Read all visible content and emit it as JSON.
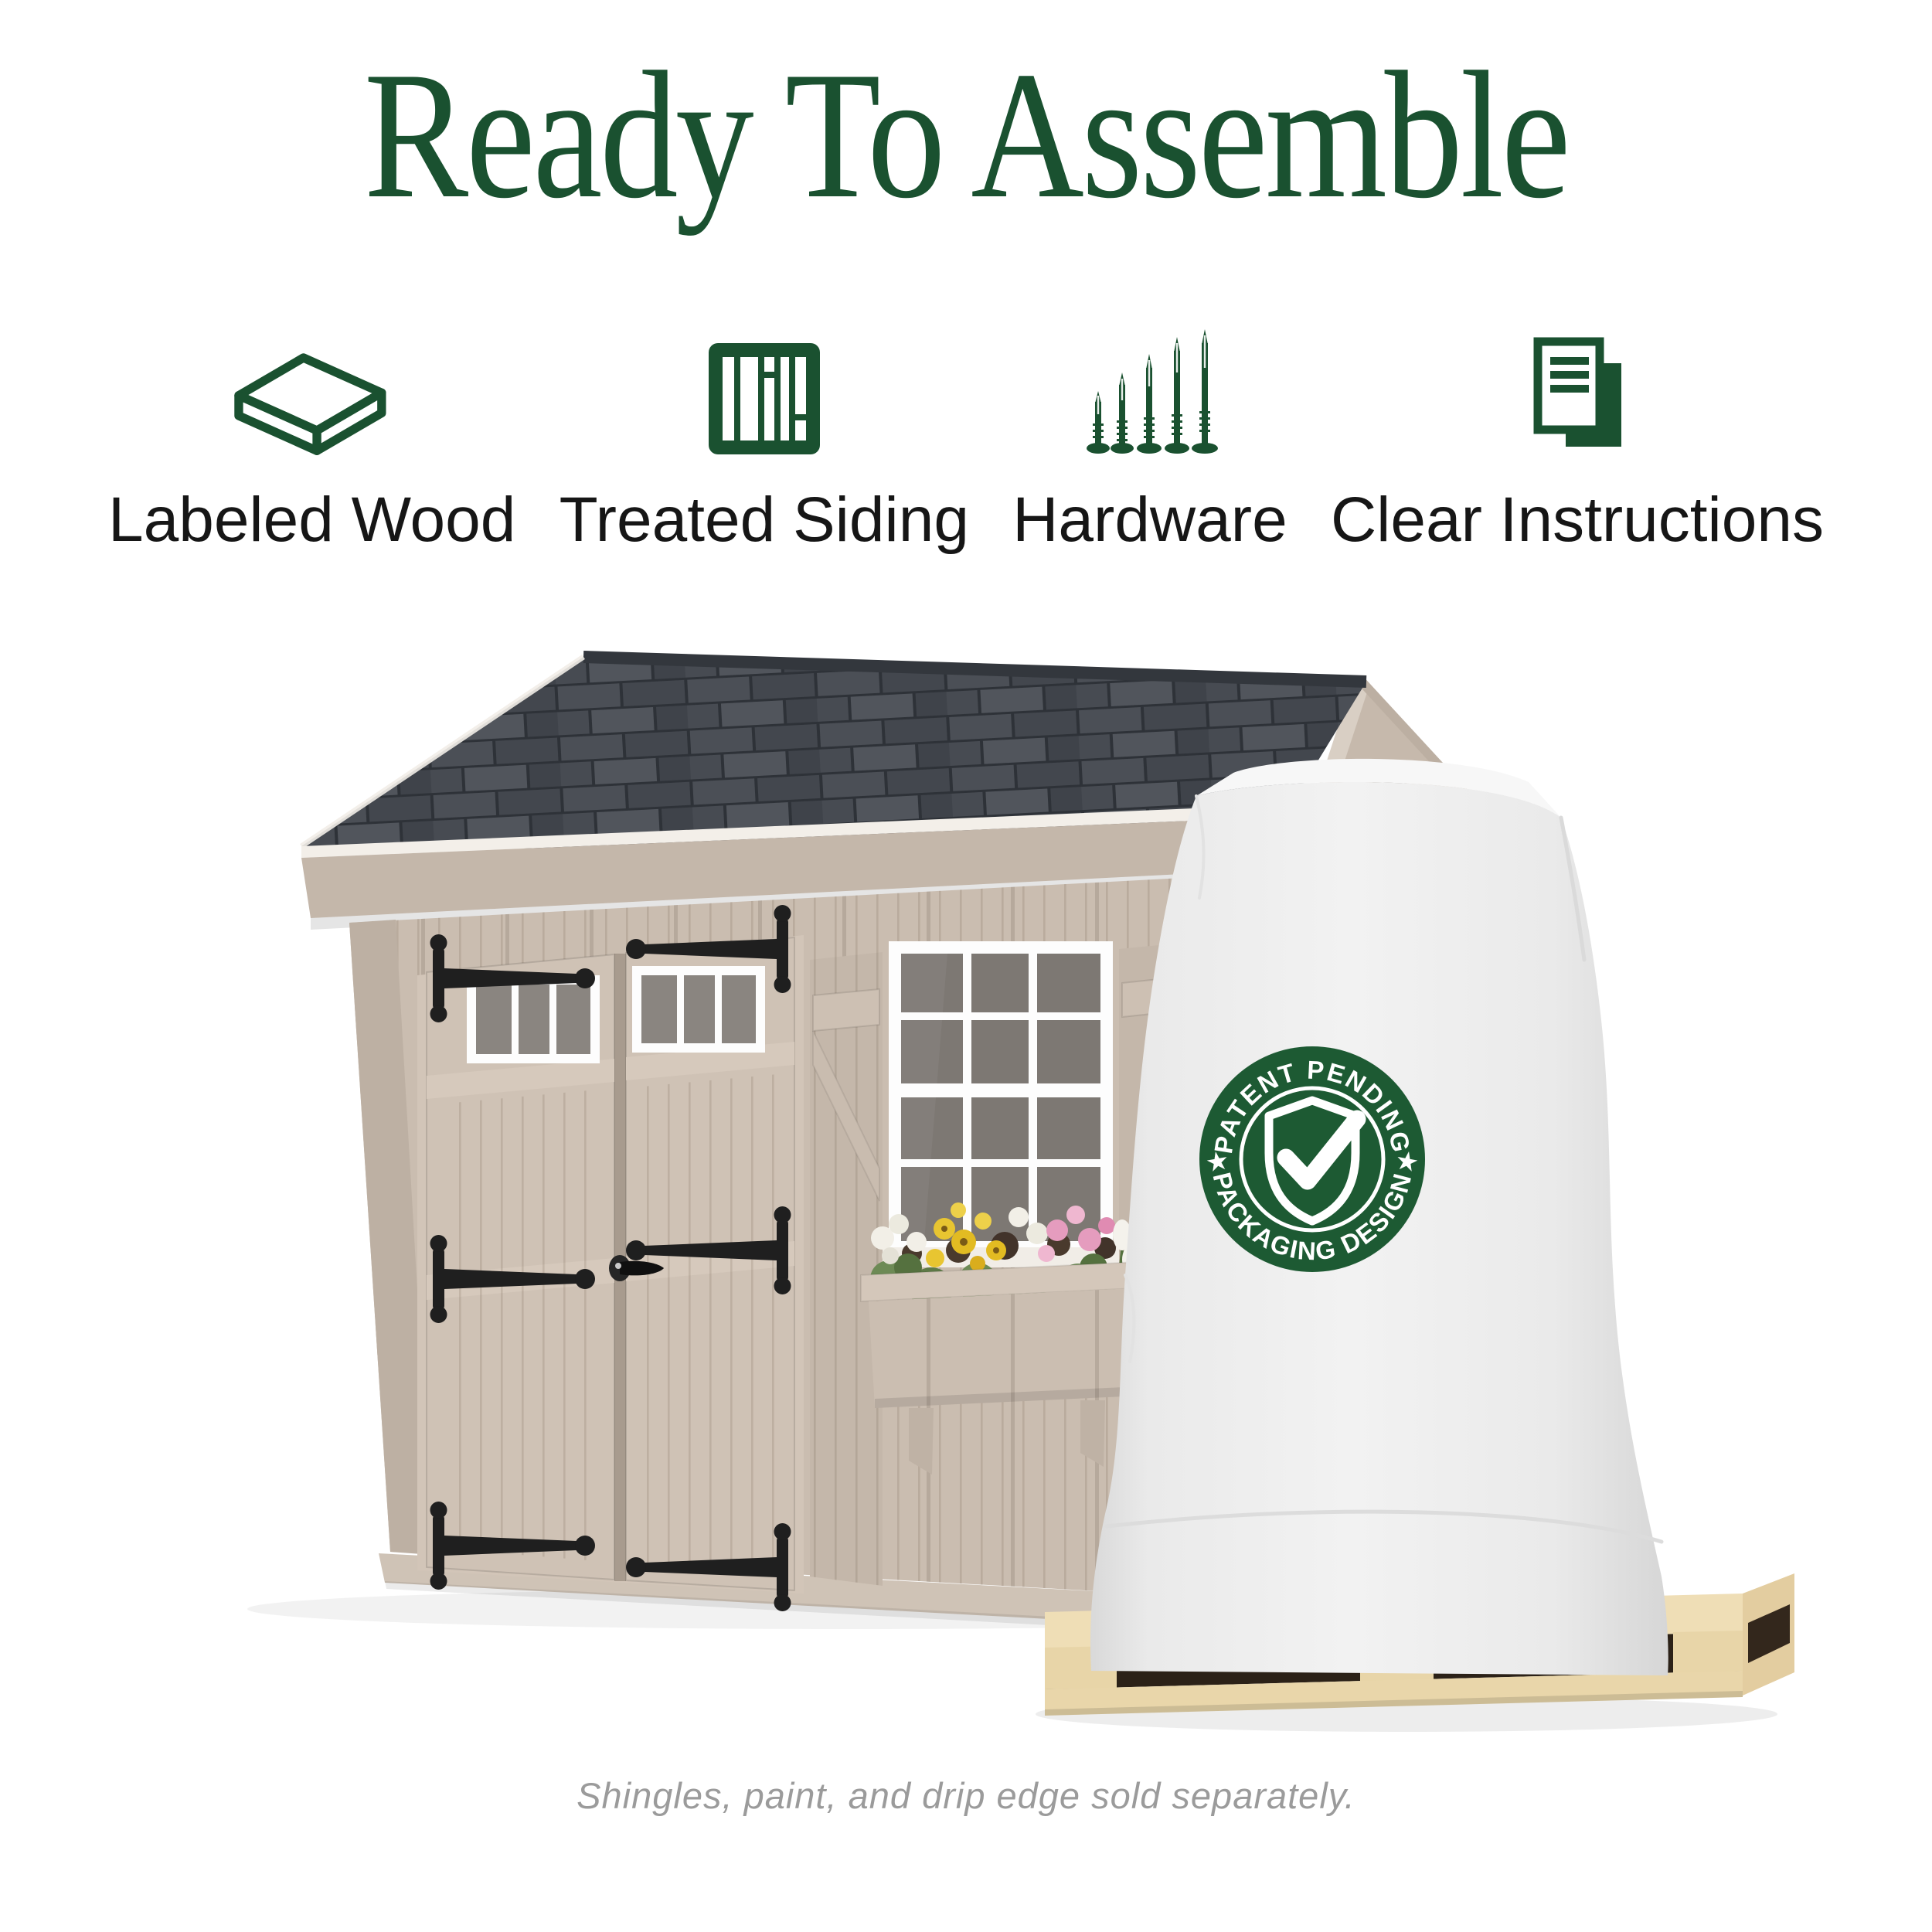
{
  "page": {
    "background": "#ffffff"
  },
  "title": {
    "text": "Ready To Assemble",
    "color": "#1A5130"
  },
  "features": {
    "icon_color": "#1A5130",
    "label_color": "#161616",
    "items": [
      {
        "label": "Labeled Wood",
        "icon": "wood-plank-icon"
      },
      {
        "label": "Treated Siding",
        "icon": "siding-panel-icon"
      },
      {
        "label": "Hardware",
        "icon": "nails-icon"
      },
      {
        "label": "Clear Instructions",
        "icon": "instructions-document-icon"
      }
    ]
  },
  "scene": {
    "description": "Tan wooden garden shed with gray shingle roof, double doors, flower-box window, and a white shrink-wrapped shed kit on a wooden shipping pallet",
    "badge": {
      "top_text": "PATENT PENDING",
      "bottom_text": "PACKAGING DESIGN",
      "star": "★",
      "icon": "shield-check-icon",
      "background": "#1D5A33",
      "text_color": "#FFFFFF"
    },
    "shed": {
      "roof_color": "#45494F",
      "siding_color": "#CABDB0",
      "trim_color": "#FFFFFF",
      "hardware_color": "#1F1F1F"
    },
    "package": {
      "wrap_color": "#EDEDED"
    },
    "pallet": {
      "wood_color": "#EFDEB6"
    }
  },
  "footer": {
    "note": "Shingles, paint, and drip edge sold separately.",
    "color": "#9B9B9B"
  }
}
